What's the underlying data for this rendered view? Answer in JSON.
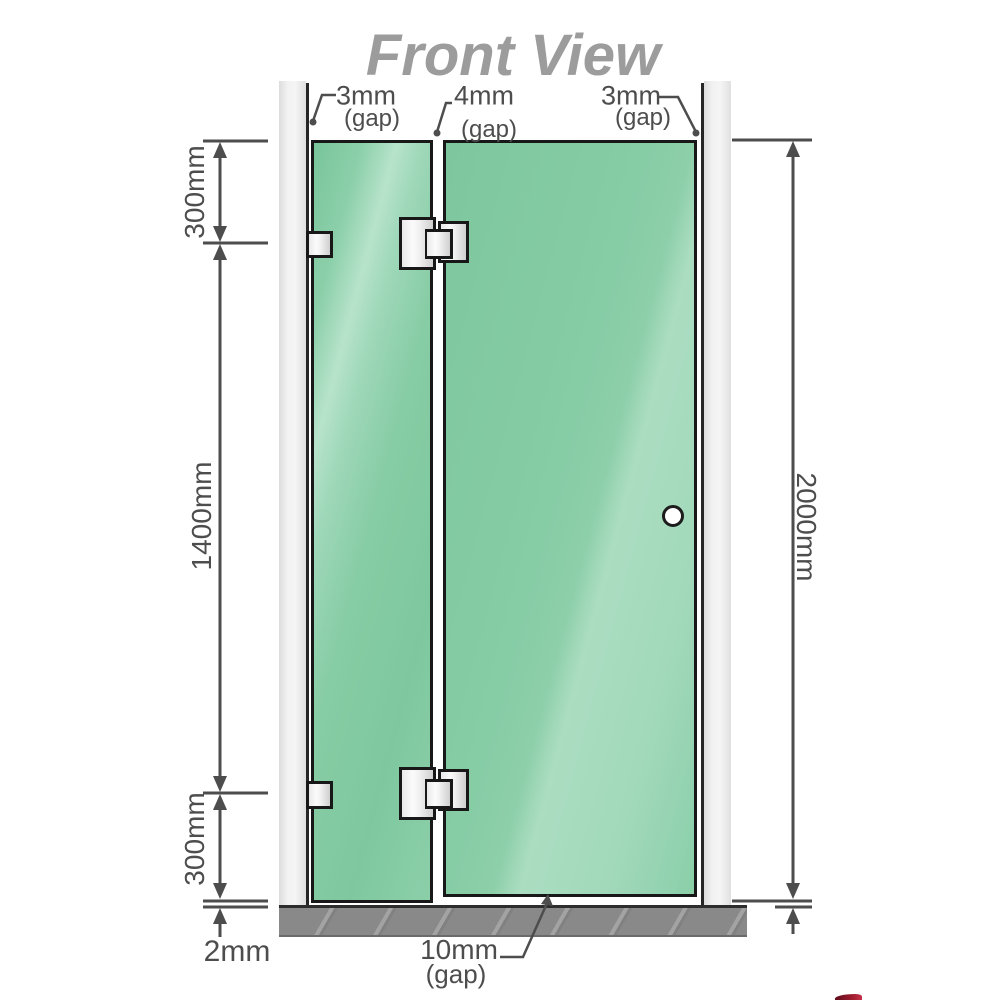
{
  "title": "Front View",
  "top_gaps": {
    "left": {
      "value": "3mm",
      "label": "(gap)"
    },
    "middle": {
      "value": "4mm",
      "label": "(gap)"
    },
    "right": {
      "value": "3mm",
      "label": "(gap)"
    }
  },
  "left_dimensions": {
    "top": "300mm",
    "middle": "1400mm",
    "bottom": "300mm",
    "floor_gap": "2mm"
  },
  "right_dimension": {
    "total_height": "2000mm"
  },
  "bottom_gap": {
    "value": "10mm",
    "label": "(gap)"
  },
  "colors": {
    "glass_green": "#85cba4",
    "glass_highlight": "#aadcc1",
    "glass_dark": "#74c198",
    "wall_gray": "#ebebeb",
    "floor_gray": "#898989",
    "outline_black": "#181818",
    "dimension_gray": "#4d4d4d",
    "title_gray": "#9c9c9c",
    "metal_light": "#fbfbfb",
    "metal_dark": "#cfcfcf",
    "accent_red": "#9c1c2e"
  }
}
